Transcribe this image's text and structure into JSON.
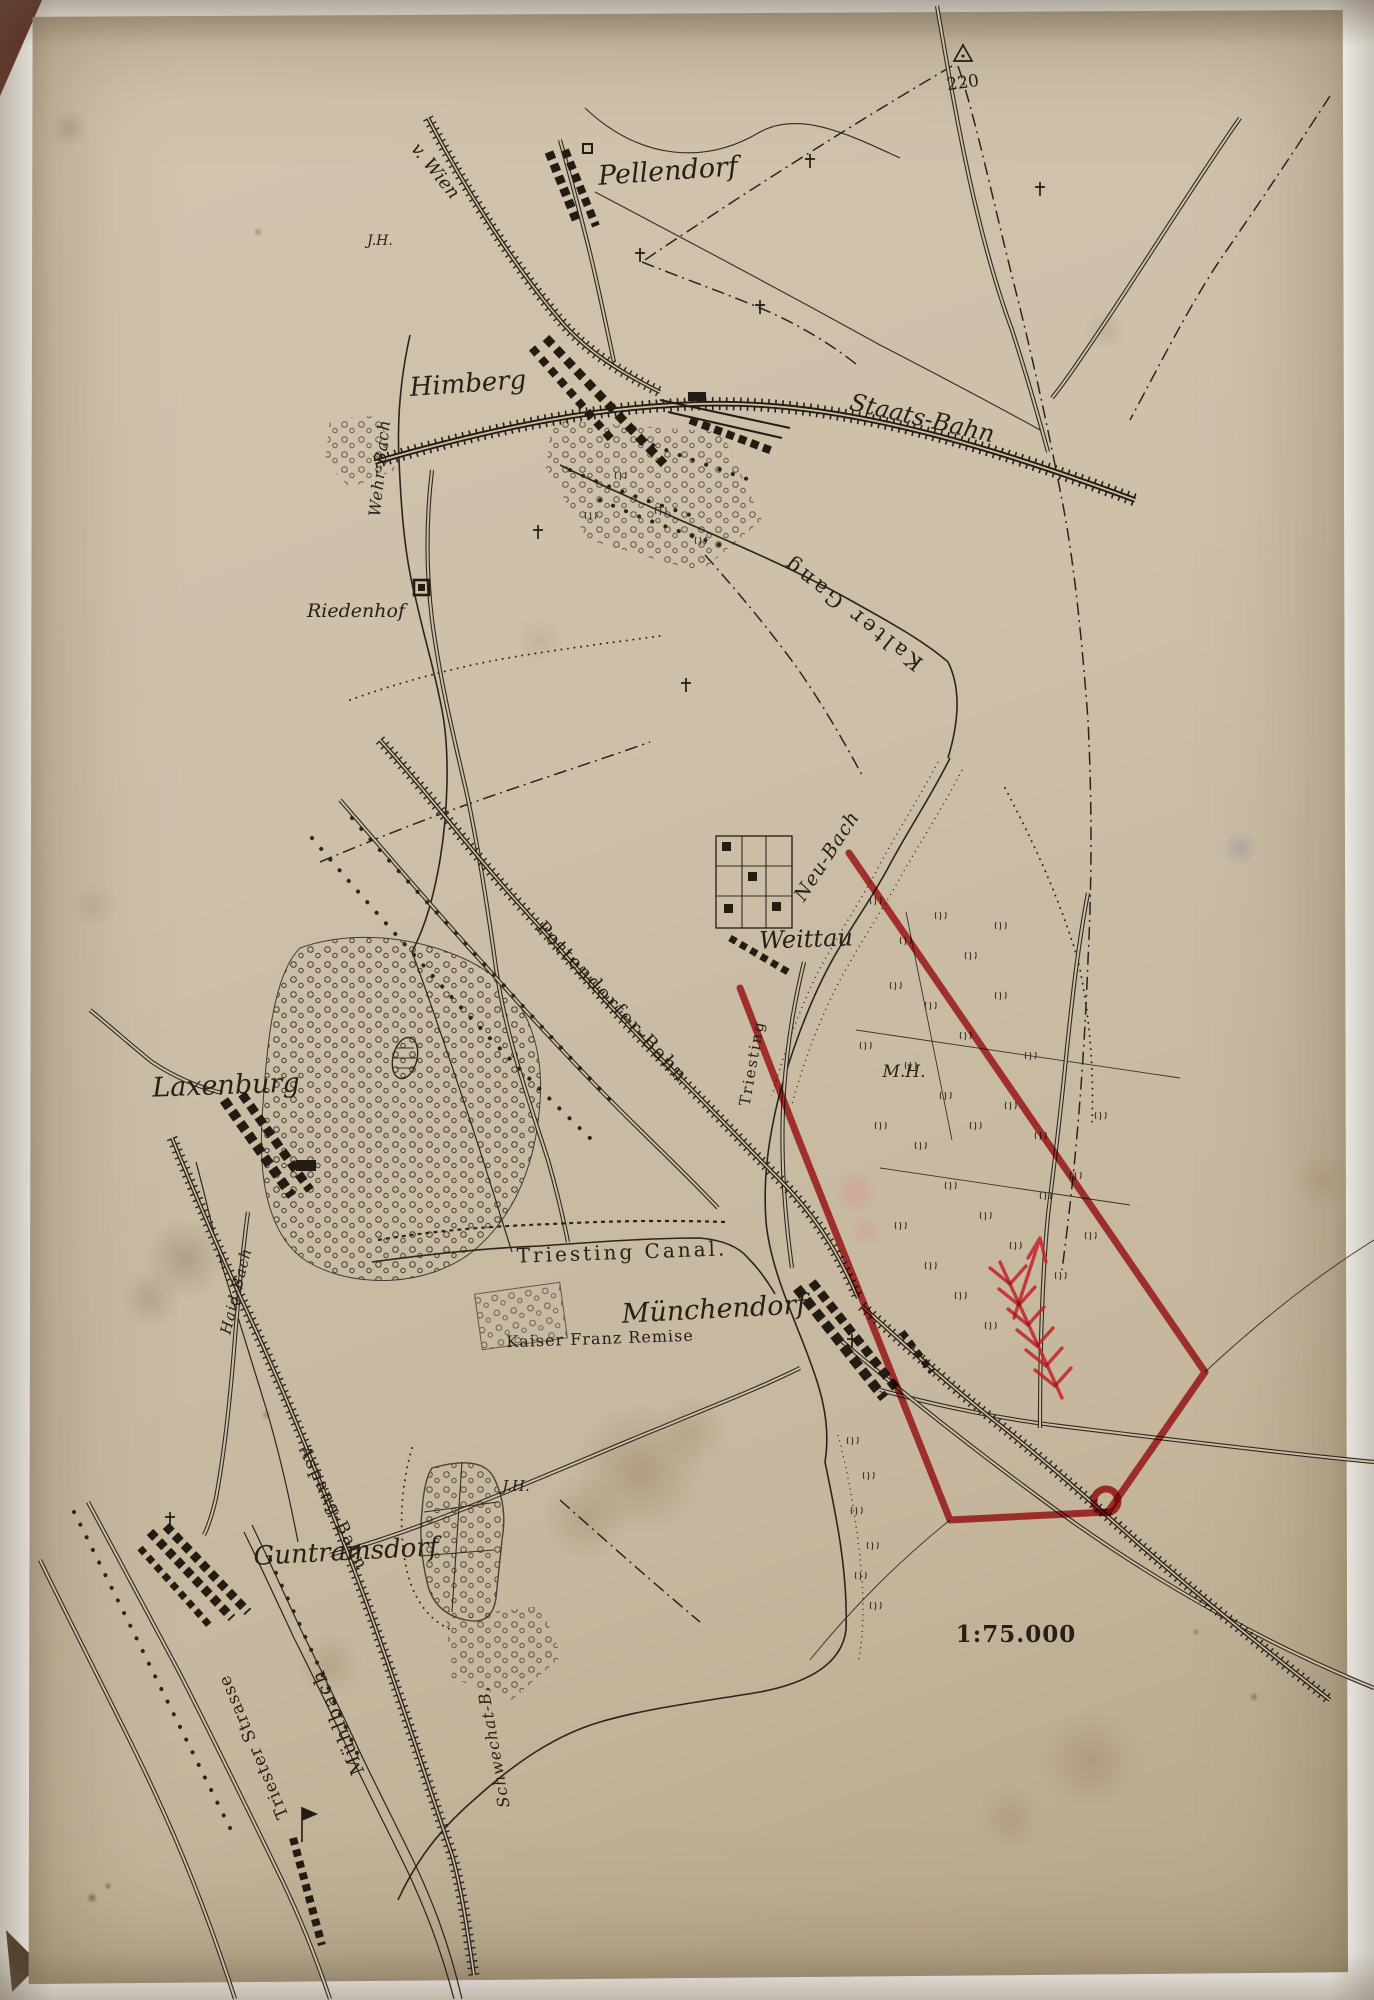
{
  "colors": {
    "paper": "#cdbfa8",
    "ink": "#2b251d",
    "annotation_red": "#c3242a"
  },
  "labels": {
    "elevation_point": "220",
    "v_wien": "v. Wien",
    "pellendorf": "Pellendorf",
    "jh_north": "J.H.",
    "himberg": "Himberg",
    "staats_bahn": "Staats-Bahn",
    "wehr_bach": "Wehr-Bach",
    "riedenhof": "Riedenhof",
    "kalter_gang": "Kalter Gang",
    "neu_bach": "Neu-Bach",
    "weittau": "Weittau",
    "pottendorfer_bahn": "Pottendorfer-Bahn",
    "triesting_river": "Triesting",
    "laxenburg": "Laxenburg",
    "mh": "M.H.",
    "triesting_canal": "Triesting Canal.",
    "muenchendorf": "Münchendorf",
    "kaiser_franz_remise": "Kaiser Franz Remise",
    "haid_bach": "Haid-Bach",
    "aspang_bahn": "Aspang-Bahn",
    "jh_south": "J.H.",
    "guntramsdorf": "Guntramsdorf",
    "triester_strasse": "Triester Strasse",
    "muehlbach": "Mühlbach",
    "schwechat_b": "Schwechat-B.",
    "scale": "1:75.000"
  }
}
